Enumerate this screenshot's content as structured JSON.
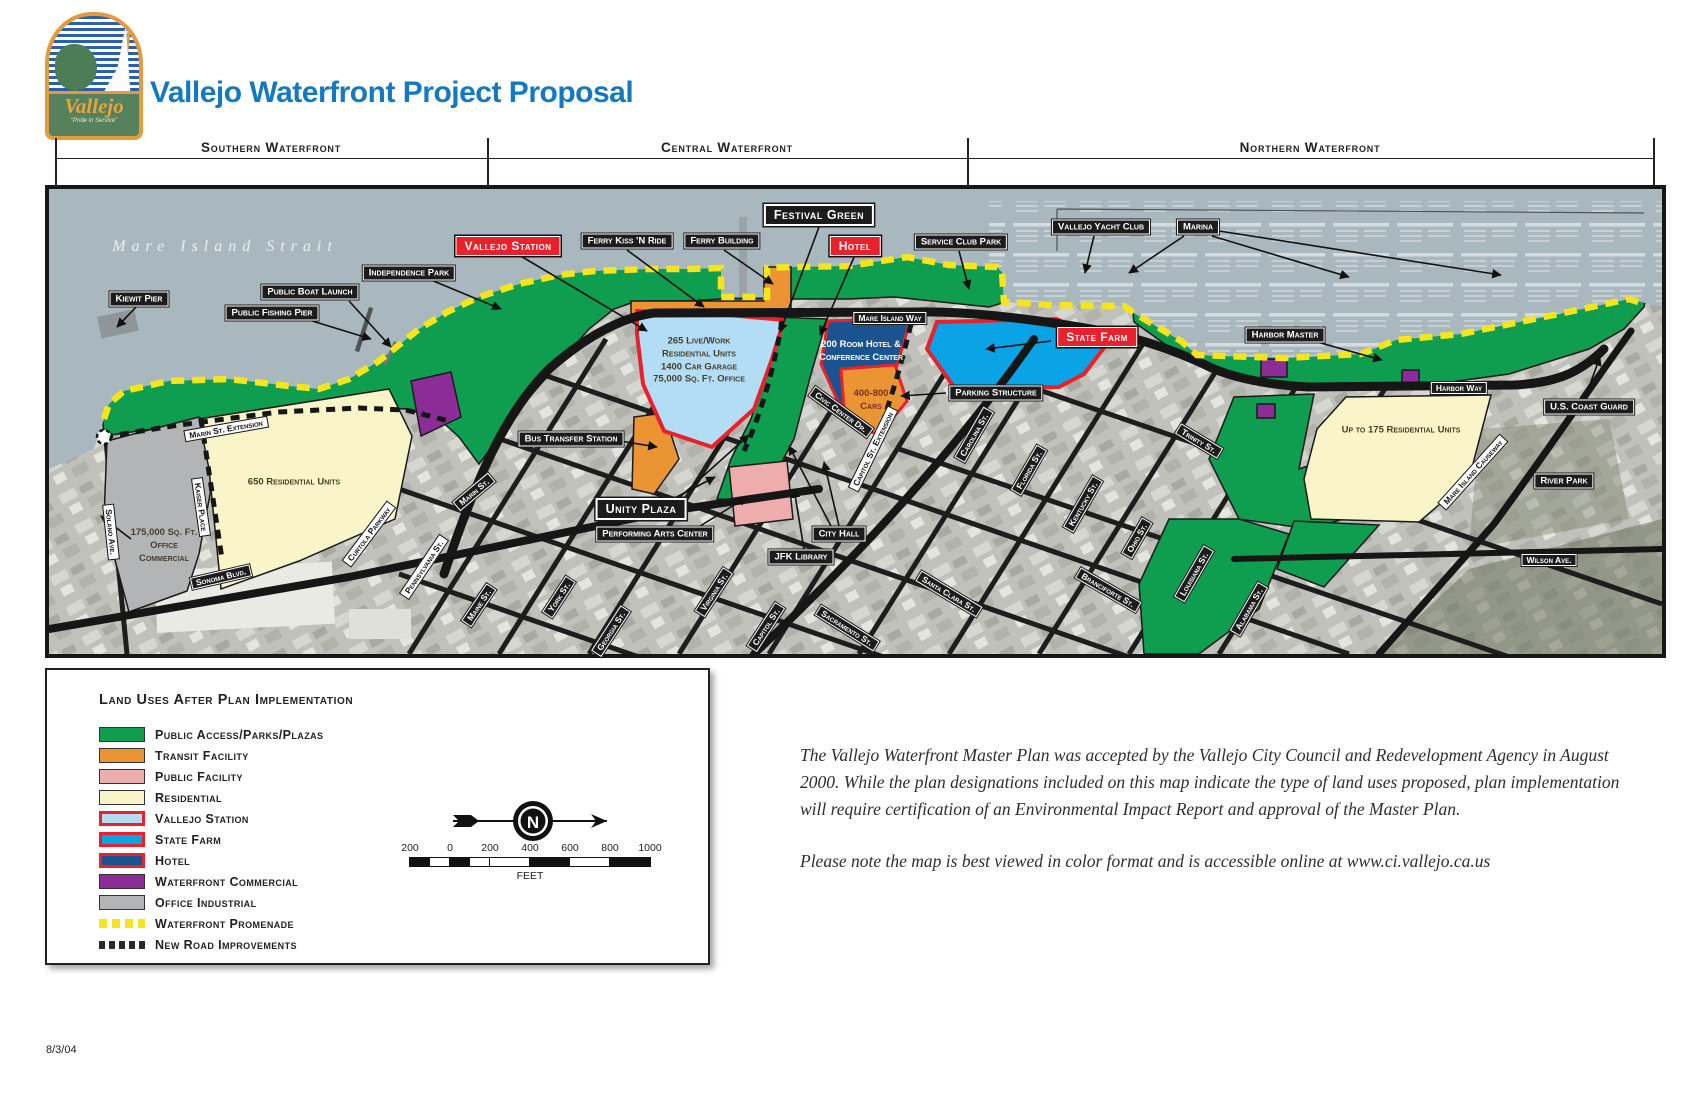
{
  "header": {
    "title": "Vallejo Waterfront Project Proposal",
    "logo": {
      "name": "Vallejo",
      "tagline": "\"Pride in Service\""
    }
  },
  "sections": {
    "southern": "Southern Waterfront",
    "central": "Central Waterfront",
    "northern": "Northern Waterfront"
  },
  "map": {
    "water_label": "Mare Island Strait",
    "labels": {
      "kiewit_pier": "Kiewit Pier",
      "public_fishing_pier": "Public Fishing Pier",
      "public_boat_launch": "Public Boat Launch",
      "independence_park": "Independence Park",
      "ferry_kiss_n_ride": "Ferry Kiss 'N Ride",
      "ferry_building": "Ferry Building",
      "service_club_park": "Service Club Park",
      "vallejo_yacht_club": "Vallejo Yacht Club",
      "marina": "Marina",
      "harbor_master": "Harbor Master",
      "parking_structure": "Parking Structure",
      "bus_transfer_station": "Bus Transfer Station",
      "performing_arts_center": "Performing Arts Center",
      "city_hall": "City Hall",
      "jfk_library": "JFK Library",
      "us_coast_guard": "U.S. Coast Guard",
      "river_park": "River Park",
      "vallejo_station": "Vallejo Station",
      "hotel": "Hotel",
      "state_farm": "State Farm",
      "festival_green": "Festival Green",
      "unity_plaza": "Unity Plaza"
    },
    "streets": {
      "marin_ext": "Marin St. Extension",
      "solano": "Solano Ave.",
      "kaiser": "Kaiser Place",
      "sonoma": "Sonoma Blvd.",
      "curtola": "Curtola Parkway",
      "pennsylvania": "Pennsylvania St.",
      "marin": "Marin St.",
      "maine": "Maine St.",
      "york": "York St.",
      "georgia": "Georgia St.",
      "virginia": "Virginia St.",
      "capitol": "Capitol St.",
      "sacramento": "Sacramento St.",
      "santa_clara": "Santa Clara St.",
      "civic_center": "Civic Center Dr.",
      "capitol_ext": "Capitol St. Extension",
      "carolina": "Carolina St.",
      "florida": "Florida St.",
      "kentucky": "Kentucky St.",
      "trinity": "Trinity St.",
      "ohio": "Ohio St.",
      "branciforte": "Branciforte St.",
      "louisiana": "Louisiana St.",
      "alabama": "Alabama St.",
      "causeway": "Mare Island Causeway",
      "mare_island_way": "Mare Island Way",
      "harbor_way": "Harbor Way",
      "wilson": "Wilson Ave."
    },
    "parcel_notes": {
      "vallejo_station_parcel": "265 Live/Work\nResidential Units\n1400 Car Garage\n75,000 Sq. Ft. Office",
      "hotel_parcel": "200 Room Hotel &\nConference Center",
      "parking_parcel": "400-800\nCars",
      "res_650": "650 Residential Units",
      "office_175k": "175,000 Sq. Ft.\nOffice\nCommercial",
      "res_175": "Up to 175 Residential Units"
    }
  },
  "legend": {
    "title": "Land Uses After Plan Implementation",
    "items": [
      {
        "label": "Public Access/Parks/Plazas",
        "color": "#0f9d4f"
      },
      {
        "label": "Transit Facility",
        "color": "#ea9434"
      },
      {
        "label": "Public Facility",
        "color": "#eeadad"
      },
      {
        "label": "Residential",
        "color": "#faf5c8"
      },
      {
        "label": "Vallejo Station",
        "color": "#b3ddf5",
        "border": "#e8212a"
      },
      {
        "label": "State Farm",
        "color": "#09a3e6",
        "border": "#e8212a"
      },
      {
        "label": "Hotel",
        "color": "#1a538f",
        "border": "#e8212a"
      },
      {
        "label": "Waterfront Commercial",
        "color": "#8c2d97"
      },
      {
        "label": "Office Industrial",
        "color": "#b2b4b6"
      },
      {
        "label": "Waterfront Promenade",
        "color": "#f6e41e",
        "style": "dashed"
      },
      {
        "label": "New Road Improvements",
        "color": "#2a2a2a",
        "style": "dashed"
      }
    ]
  },
  "compass": {
    "north": "N"
  },
  "scale": {
    "ticks": [
      "200",
      "0",
      "200",
      "400",
      "600",
      "800",
      "1000"
    ],
    "unit": "FEET"
  },
  "notes": {
    "p1": "The Vallejo Waterfront Master Plan was accepted by the Vallejo City Council and Redevelopment Agency in August 2000. While the plan designations included on this map indicate the type of land uses proposed, plan implementation will require certification of an Environmental Impact Report and approval of the Master Plan.",
    "p2": "Please note the map is best viewed in color format and is accessible online at www.ci.vallejo.ca.us"
  },
  "footer": {
    "date": "8/3/04"
  }
}
